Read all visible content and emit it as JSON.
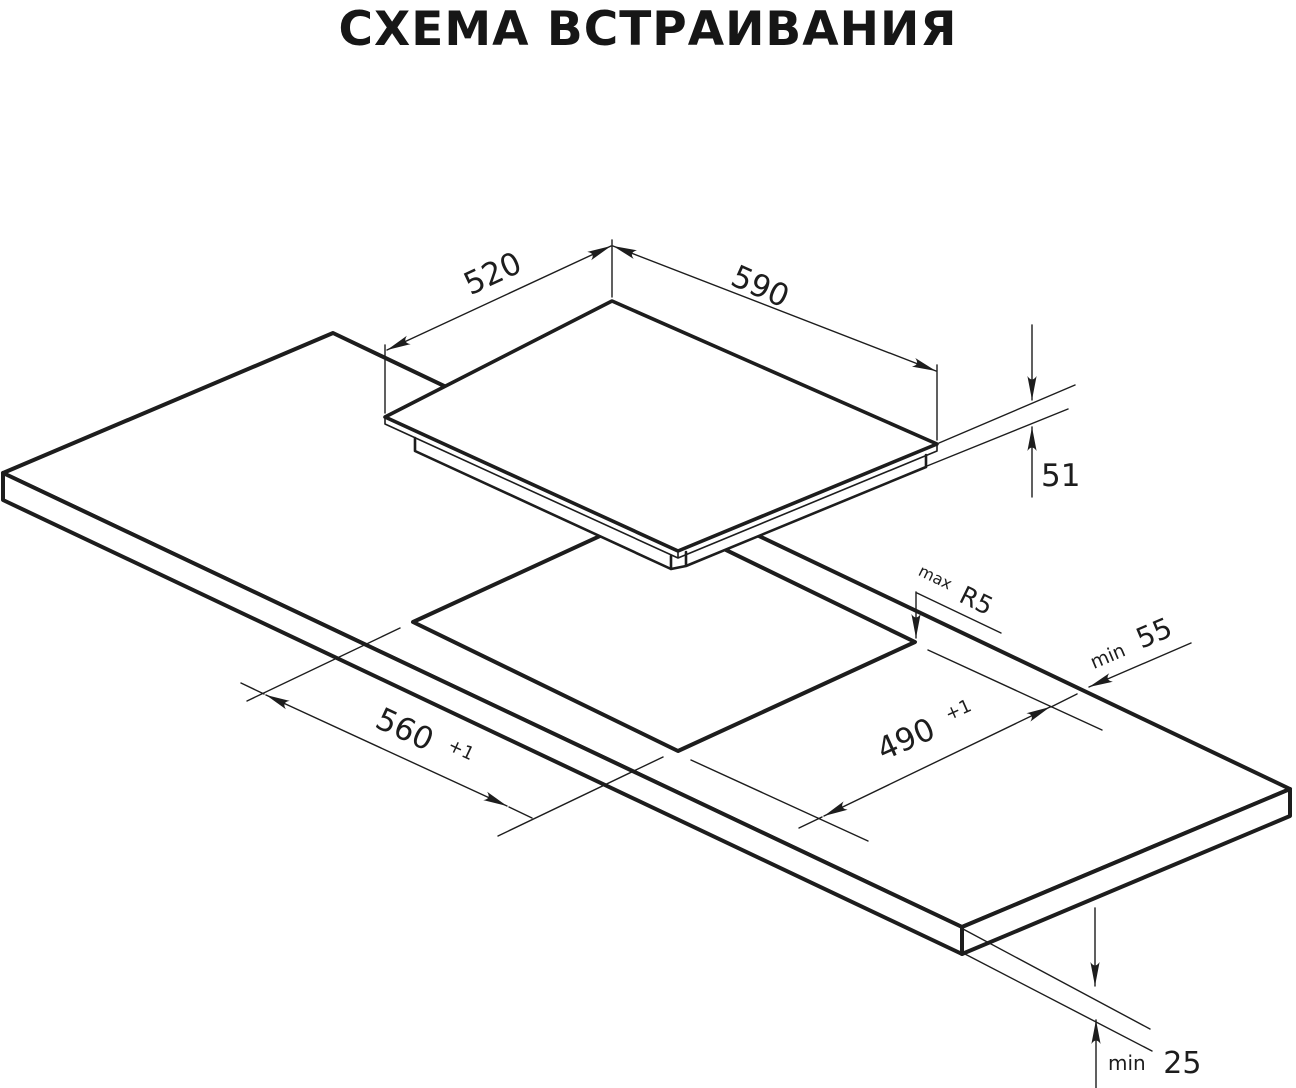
{
  "title": "СХЕМА ВСТРАИВАНИЯ",
  "colors": {
    "ink": "#1d1d1d",
    "background": "#ffffff"
  },
  "diagram": {
    "kind": "isometric installation drawing of built-in hob over worktop cutout",
    "dimensions": {
      "hob_depth": {
        "value": "520"
      },
      "hob_width": {
        "value": "590"
      },
      "hob_height": {
        "value": "51"
      },
      "cutout_depth": {
        "value": "560",
        "tolerance": "+1"
      },
      "cutout_width": {
        "value": "490",
        "tolerance": "+1"
      },
      "corner_radius": {
        "prefix": "max",
        "value": "R5"
      },
      "rear_edge_clearance": {
        "prefix": "min",
        "value": "55"
      },
      "worktop_thickness": {
        "prefix": "min",
        "value": "25"
      }
    }
  }
}
